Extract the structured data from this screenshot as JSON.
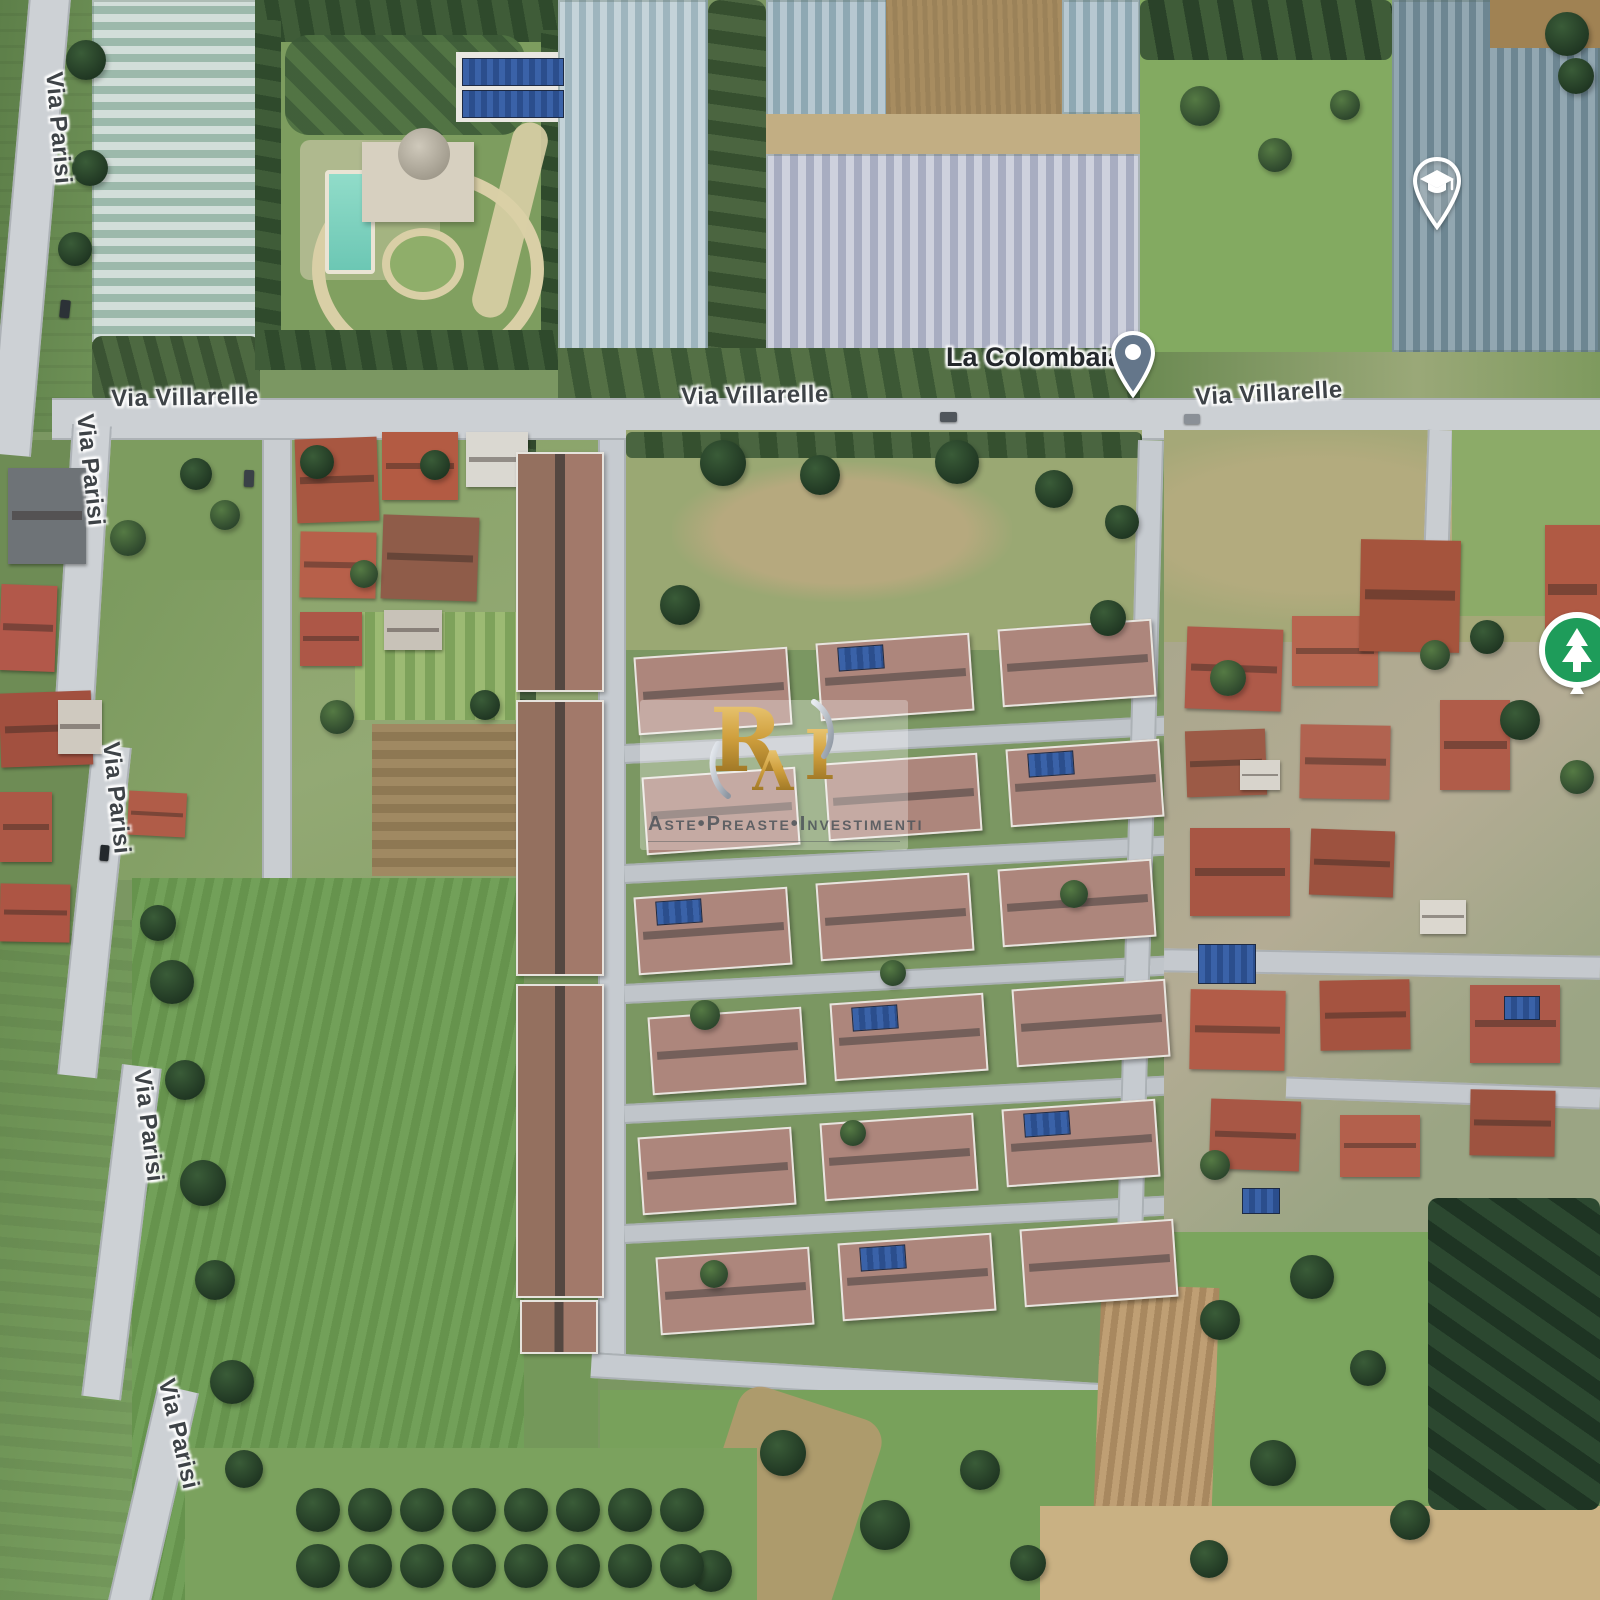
{
  "map": {
    "type": "satellite",
    "road_labels": [
      {
        "id": "via-parisi-1",
        "text": "Via Parisi"
      },
      {
        "id": "via-parisi-2",
        "text": "Via Parisi"
      },
      {
        "id": "via-parisi-3",
        "text": "Via Parisi"
      },
      {
        "id": "via-parisi-4",
        "text": "Via Parisi"
      },
      {
        "id": "via-parisi-5",
        "text": "Via Parisi"
      },
      {
        "id": "via-villarelle-1",
        "text": "Via Villarelle"
      },
      {
        "id": "via-villarelle-2",
        "text": "Via Villarelle"
      },
      {
        "id": "via-villarelle-3",
        "text": "Via Villarelle"
      }
    ],
    "place": {
      "name": "La Colombaia"
    },
    "markers": [
      {
        "name": "la-colombaia-pin",
        "type": "place",
        "color": "#64768a"
      },
      {
        "name": "school-pin",
        "type": "school",
        "color": "#ffffff"
      },
      {
        "name": "park-pin",
        "type": "park",
        "color": "#1e9c5a"
      }
    ]
  },
  "watermark": {
    "monogram_parts": [
      "R",
      "Λ",
      "I"
    ],
    "label": "Aste•Preaste•Investimenti",
    "gold_color": "#cf9f3d"
  },
  "colors": {
    "road": "#ccd0d4",
    "field_green": "#72a059",
    "greenhouse_blue": "#9eb5be",
    "roof_red": "#ae5a49",
    "roof_dev": "#ad867c"
  }
}
